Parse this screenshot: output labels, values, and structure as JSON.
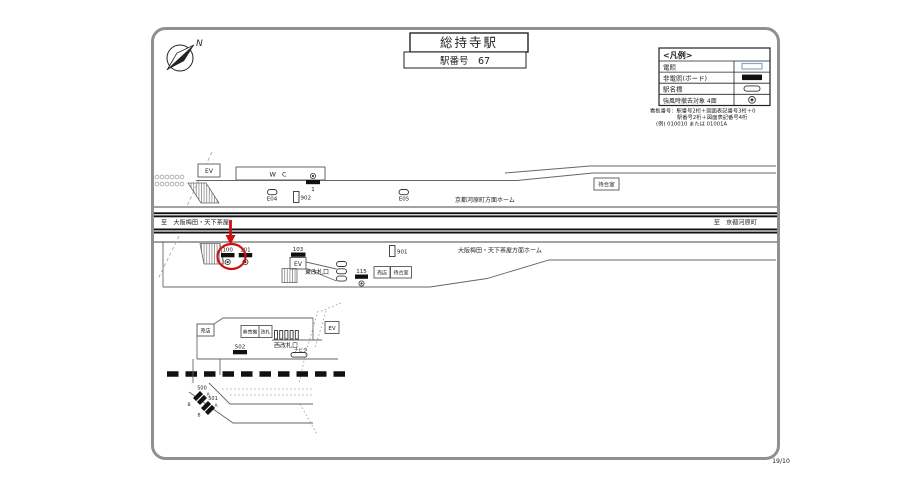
{
  "page": {
    "number": "19/10"
  },
  "compass": {
    "north_label": "N"
  },
  "title": {
    "station_name": "総持寺駅",
    "station_number": "駅番号　67"
  },
  "legend": {
    "title": "<凡例>",
    "items": [
      {
        "label": "電照",
        "symbol": "lit-rect"
      },
      {
        "label": "非電照(ボード)",
        "symbol": "black-rect"
      },
      {
        "label": "駅名標",
        "symbol": "station-sign-oval"
      },
      {
        "label": "強風時撤去対象 4面",
        "symbol": "double-circle"
      }
    ]
  },
  "numbering_note": {
    "line1": "看板番号：駅番号2桁＋図面表記番号3桁＋0",
    "line2": "駅番号2桁＋図面表記番号4桁",
    "line3": "(例) 010010 または 01001A"
  },
  "upper_platform": {
    "elevator_label": "EV",
    "toilet_label": "W C",
    "sign_1": "1",
    "sign_e04": "E04",
    "sign_902": "902",
    "sign_e05": "E05",
    "waiting_room_label": "待合室",
    "platform_label": "京都河原町方面ホーム"
  },
  "tracks": {
    "to_umeda": "至　大阪梅田・天下茶屋",
    "to_kawaramachi": "至　京都河原町"
  },
  "lower_platform": {
    "sign_100": "100",
    "sign_101": "101",
    "sign_103": "103",
    "elevator_label": "EV",
    "east_gate_label": "東改札口",
    "sign_115": "115",
    "shop_label": "売店",
    "waiting_room_label": "待合室",
    "sign_901": "901",
    "platform_label": "大阪梅田・天下茶屋方面ホーム"
  },
  "west_concourse": {
    "shop_label": "売店",
    "ticket_machine_label": "券売機",
    "gate_label": "改札",
    "west_gate_label": "西改札口",
    "sign_502": "502",
    "navita_label": "ナビタ",
    "elevator_label": "EV"
  },
  "crossing": {
    "sign_500": "500",
    "sign_500_a": "A",
    "sign_500_b": "B",
    "sign_501": "501",
    "sign_501_a": "A",
    "sign_501_b": "B"
  },
  "colors": {
    "highlight_red": "#cc1111",
    "frame_gray": "#909090",
    "line_dark": "#111111",
    "lit_symbol_outline": "#8aa8cc"
  }
}
